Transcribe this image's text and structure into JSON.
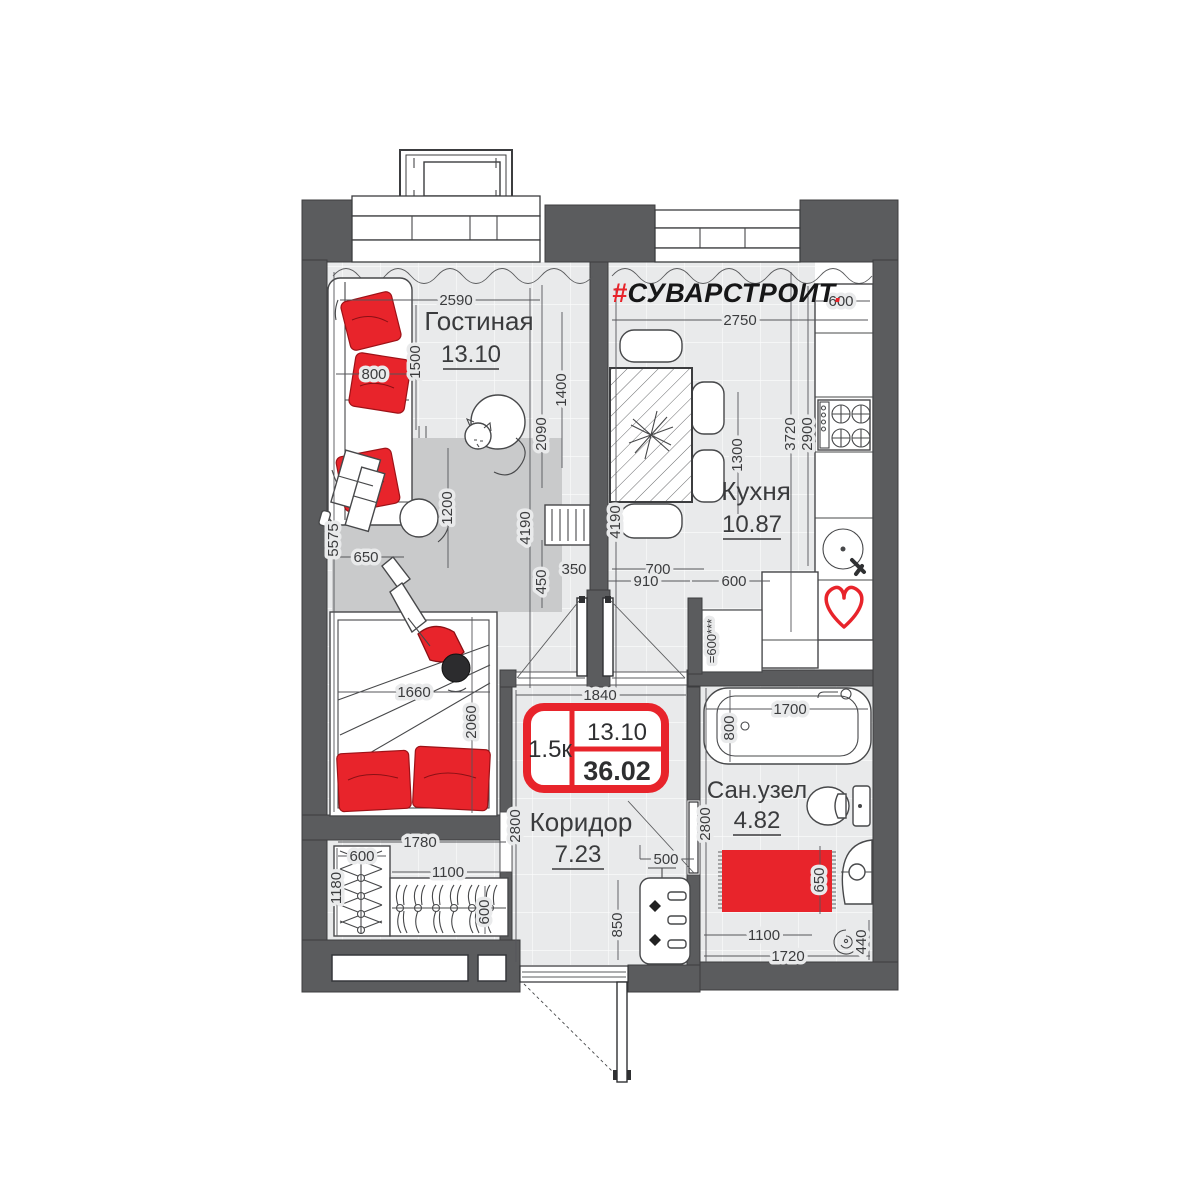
{
  "logo": {
    "hash": "#",
    "name": "СУВАРСТРОИТ",
    "dot": "."
  },
  "rooms": {
    "living": {
      "name": "Гостиная",
      "area": "13.10"
    },
    "kitchen": {
      "name": "Кухня",
      "area": "10.87"
    },
    "corridor": {
      "name": "Коридор",
      "area": "7.23"
    },
    "bathroom": {
      "name": "Сан.узел",
      "area": "4.82"
    }
  },
  "badge": {
    "rooms": "1.5к",
    "living_area": "13.10",
    "total_area": "36.02"
  },
  "dims": {
    "living": {
      "width": "2590",
      "sofa": "800",
      "sofa_len": "1500",
      "tv_wall": "2090",
      "tv": "1400",
      "depth": "4190",
      "radiator": "450",
      "gap": "350",
      "rug": "1200",
      "side": "5575",
      "side_gap": "650",
      "bed_width": "1660",
      "bed_length": "2060"
    },
    "kitchen": {
      "width": "2750",
      "table": "1300",
      "depth": "4190",
      "chair": "700",
      "door": "910",
      "niche": "600",
      "counter": "600",
      "wall": "3720",
      "inner": "2900",
      "closet": "=600***"
    },
    "corridor": {
      "width": "1840",
      "depth": "2800",
      "hook": "500",
      "cabinet": "850"
    },
    "bathroom": {
      "bath_len": "1700",
      "bath_w": "800",
      "depth": "2800",
      "rug": "650",
      "washer_wall": "1100",
      "width": "1720",
      "washer": "440"
    },
    "wardrobe": {
      "rod": "1780",
      "rod2": "1100",
      "shelf": "600",
      "side": "1180",
      "depth": "600"
    }
  },
  "colors": {
    "wall": "#5b5c5e",
    "accent": "#e8242b",
    "floor": "#e9eaeb",
    "rug": "#c9cacb"
  }
}
